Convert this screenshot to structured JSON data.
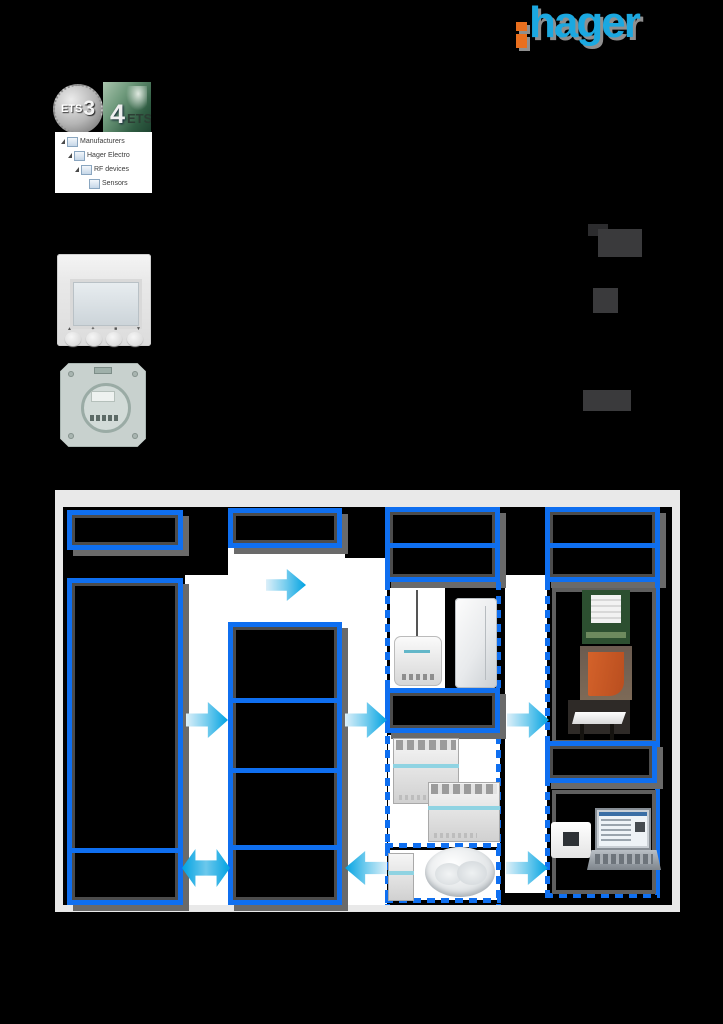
{
  "page": {
    "background": "#000000"
  },
  "logo": {
    "brand": "hager",
    "blue": "#1ba8e0",
    "orange": "#e96f1e"
  },
  "badges": {
    "ets3": {
      "name": "ETS",
      "version": "3"
    },
    "ets4": {
      "version": "4",
      "name": "ETS"
    }
  },
  "tree": {
    "items": [
      {
        "label": "Manufacturers"
      },
      {
        "label": "Hager Electro"
      },
      {
        "label": "RF devices"
      },
      {
        "label": "Sensors"
      }
    ]
  },
  "diagram": {
    "canvas_color": "#e9e9e9",
    "box_border_color": "#0f6ff0",
    "box_shadow_color": "#6a6a6a",
    "arrow_color": "#00a2e2",
    "pictured_products": [
      "radio-module-with-antenna",
      "wall-mounted-transmitter",
      "din-rail-actuator",
      "din-rail-actuator-wide",
      "din-rail-module",
      "ceiling-motion-detector",
      "roller-shutter-window-photo",
      "awning-photo",
      "table-photo",
      "wall-switch",
      "laptop-with-ets-software"
    ]
  }
}
